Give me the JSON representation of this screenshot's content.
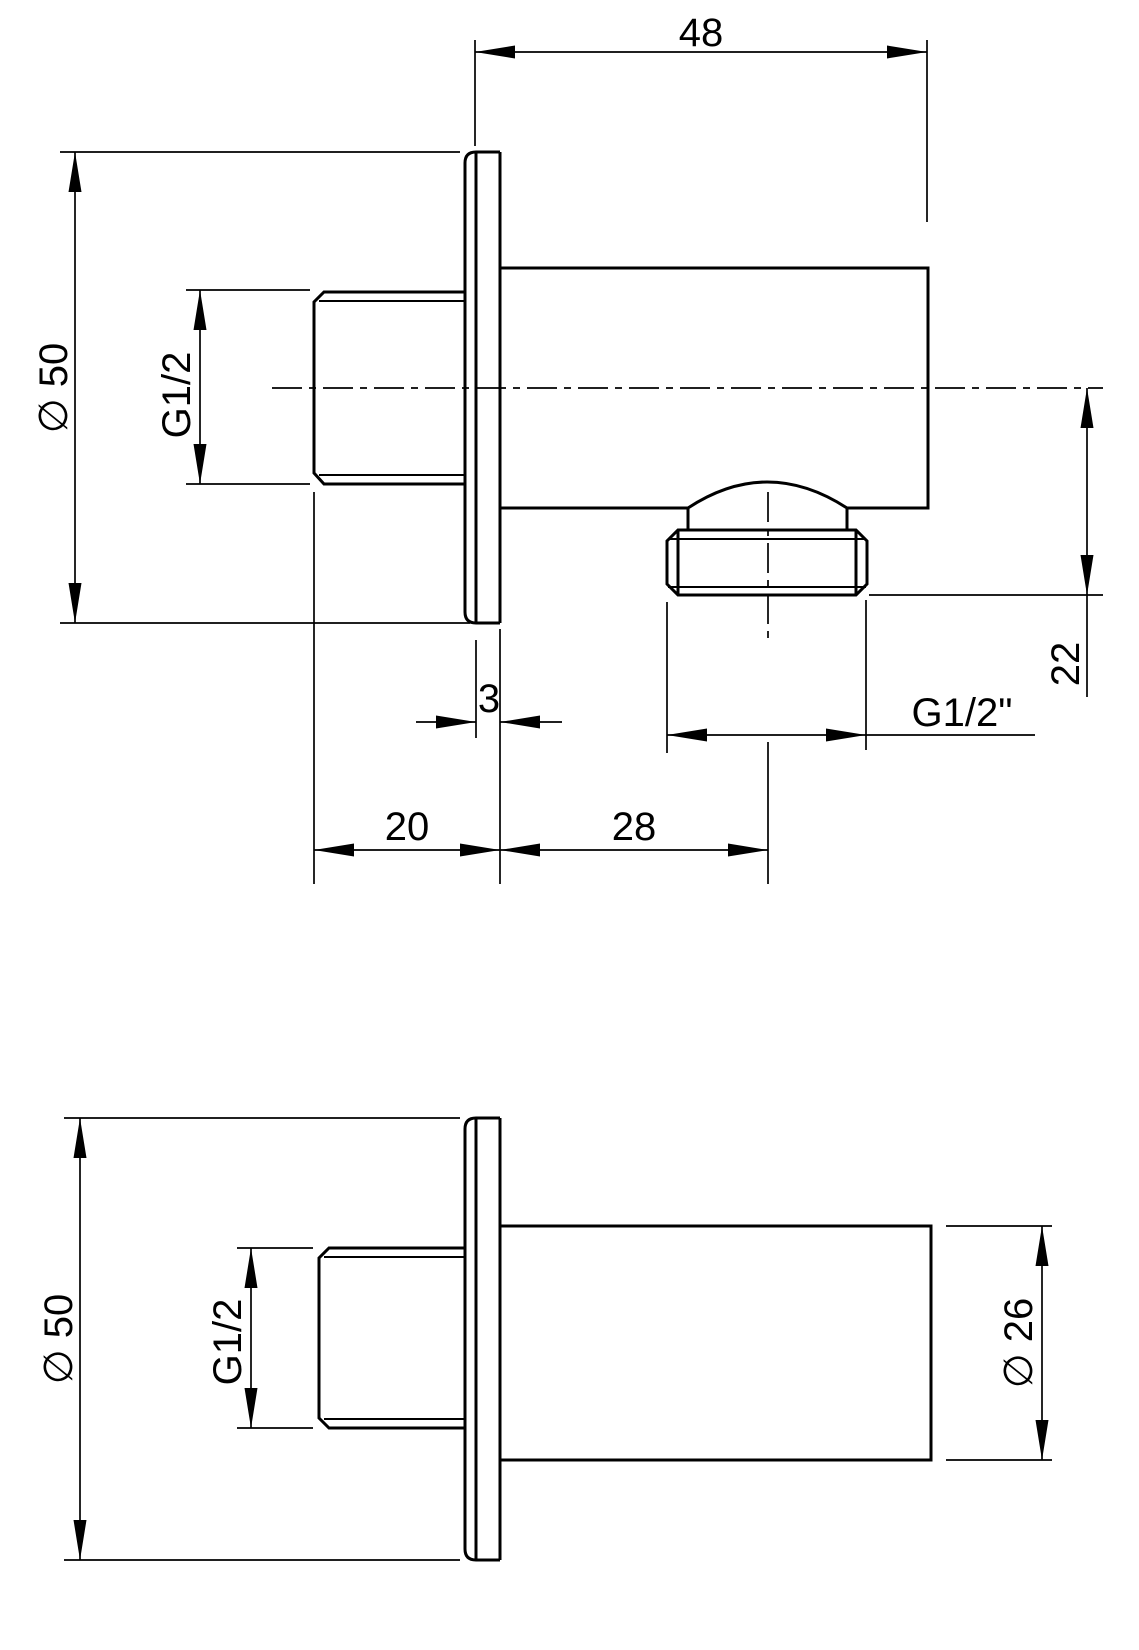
{
  "drawing": {
    "background_color": "#ffffff",
    "line_color": "#000000",
    "views": {
      "side_view": {
        "dims": {
          "body_length": "48",
          "flange_diameter": "∅ 50",
          "inlet_thread": "G1/2",
          "flange_thickness": "3",
          "outlet_drop": "22",
          "outlet_thread": "G1/2\"",
          "wall_depth": "20",
          "outlet_offset": "28"
        }
      },
      "front_view": {
        "dims": {
          "flange_diameter": "∅ 50",
          "inlet_thread": "G1/2",
          "body_diameter": "∅ 26"
        }
      }
    }
  }
}
